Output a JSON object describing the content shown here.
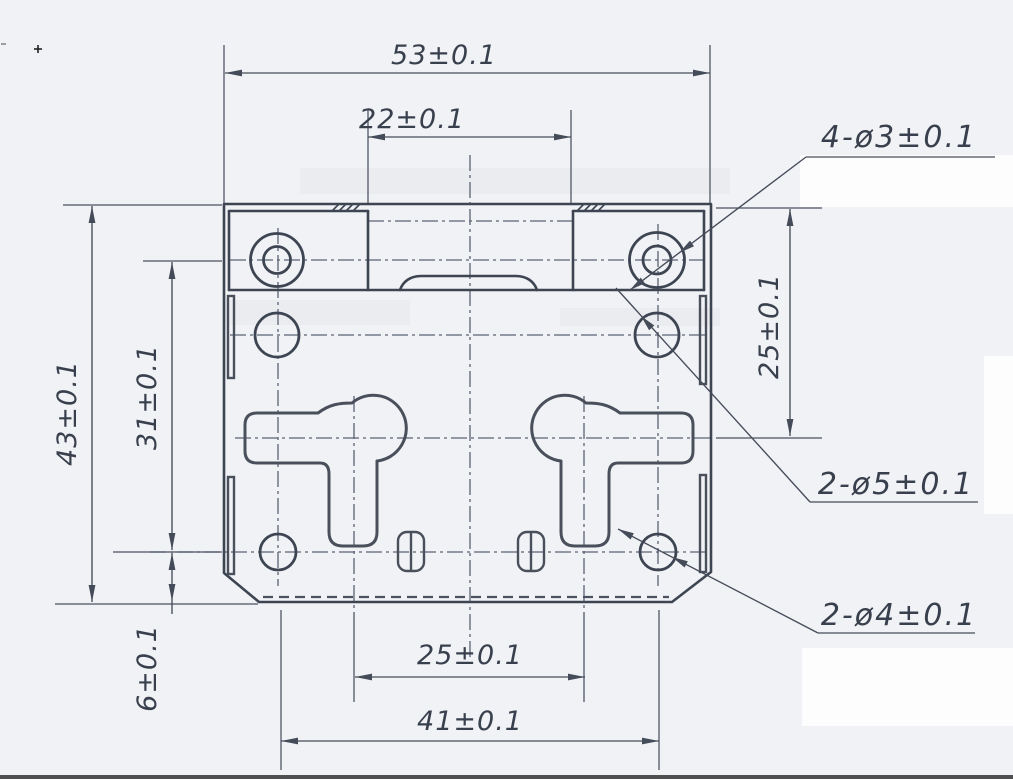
{
  "drawing": {
    "dims": {
      "total_width": "53±0.1",
      "notch_width": "22±0.1",
      "right_offset": "25±0.1",
      "total_height": "43±0.1",
      "left_span": "31±0.1",
      "bottom_edge_offset": "6±0.1",
      "slot_spacing": "25±0.1",
      "lower_hole_spacing": "41±0.1"
    },
    "callouts": {
      "corner_holes": "4-ø3±0.1",
      "mid_holes": "2-ø5±0.1",
      "lower_holes": "2-ø4±0.1"
    },
    "marks": {
      "registration": "+"
    },
    "colors": {
      "paper": "#f1f2f5",
      "outline": "#3e4552",
      "centerline": "#5a6274",
      "text": "#39404d"
    }
  }
}
